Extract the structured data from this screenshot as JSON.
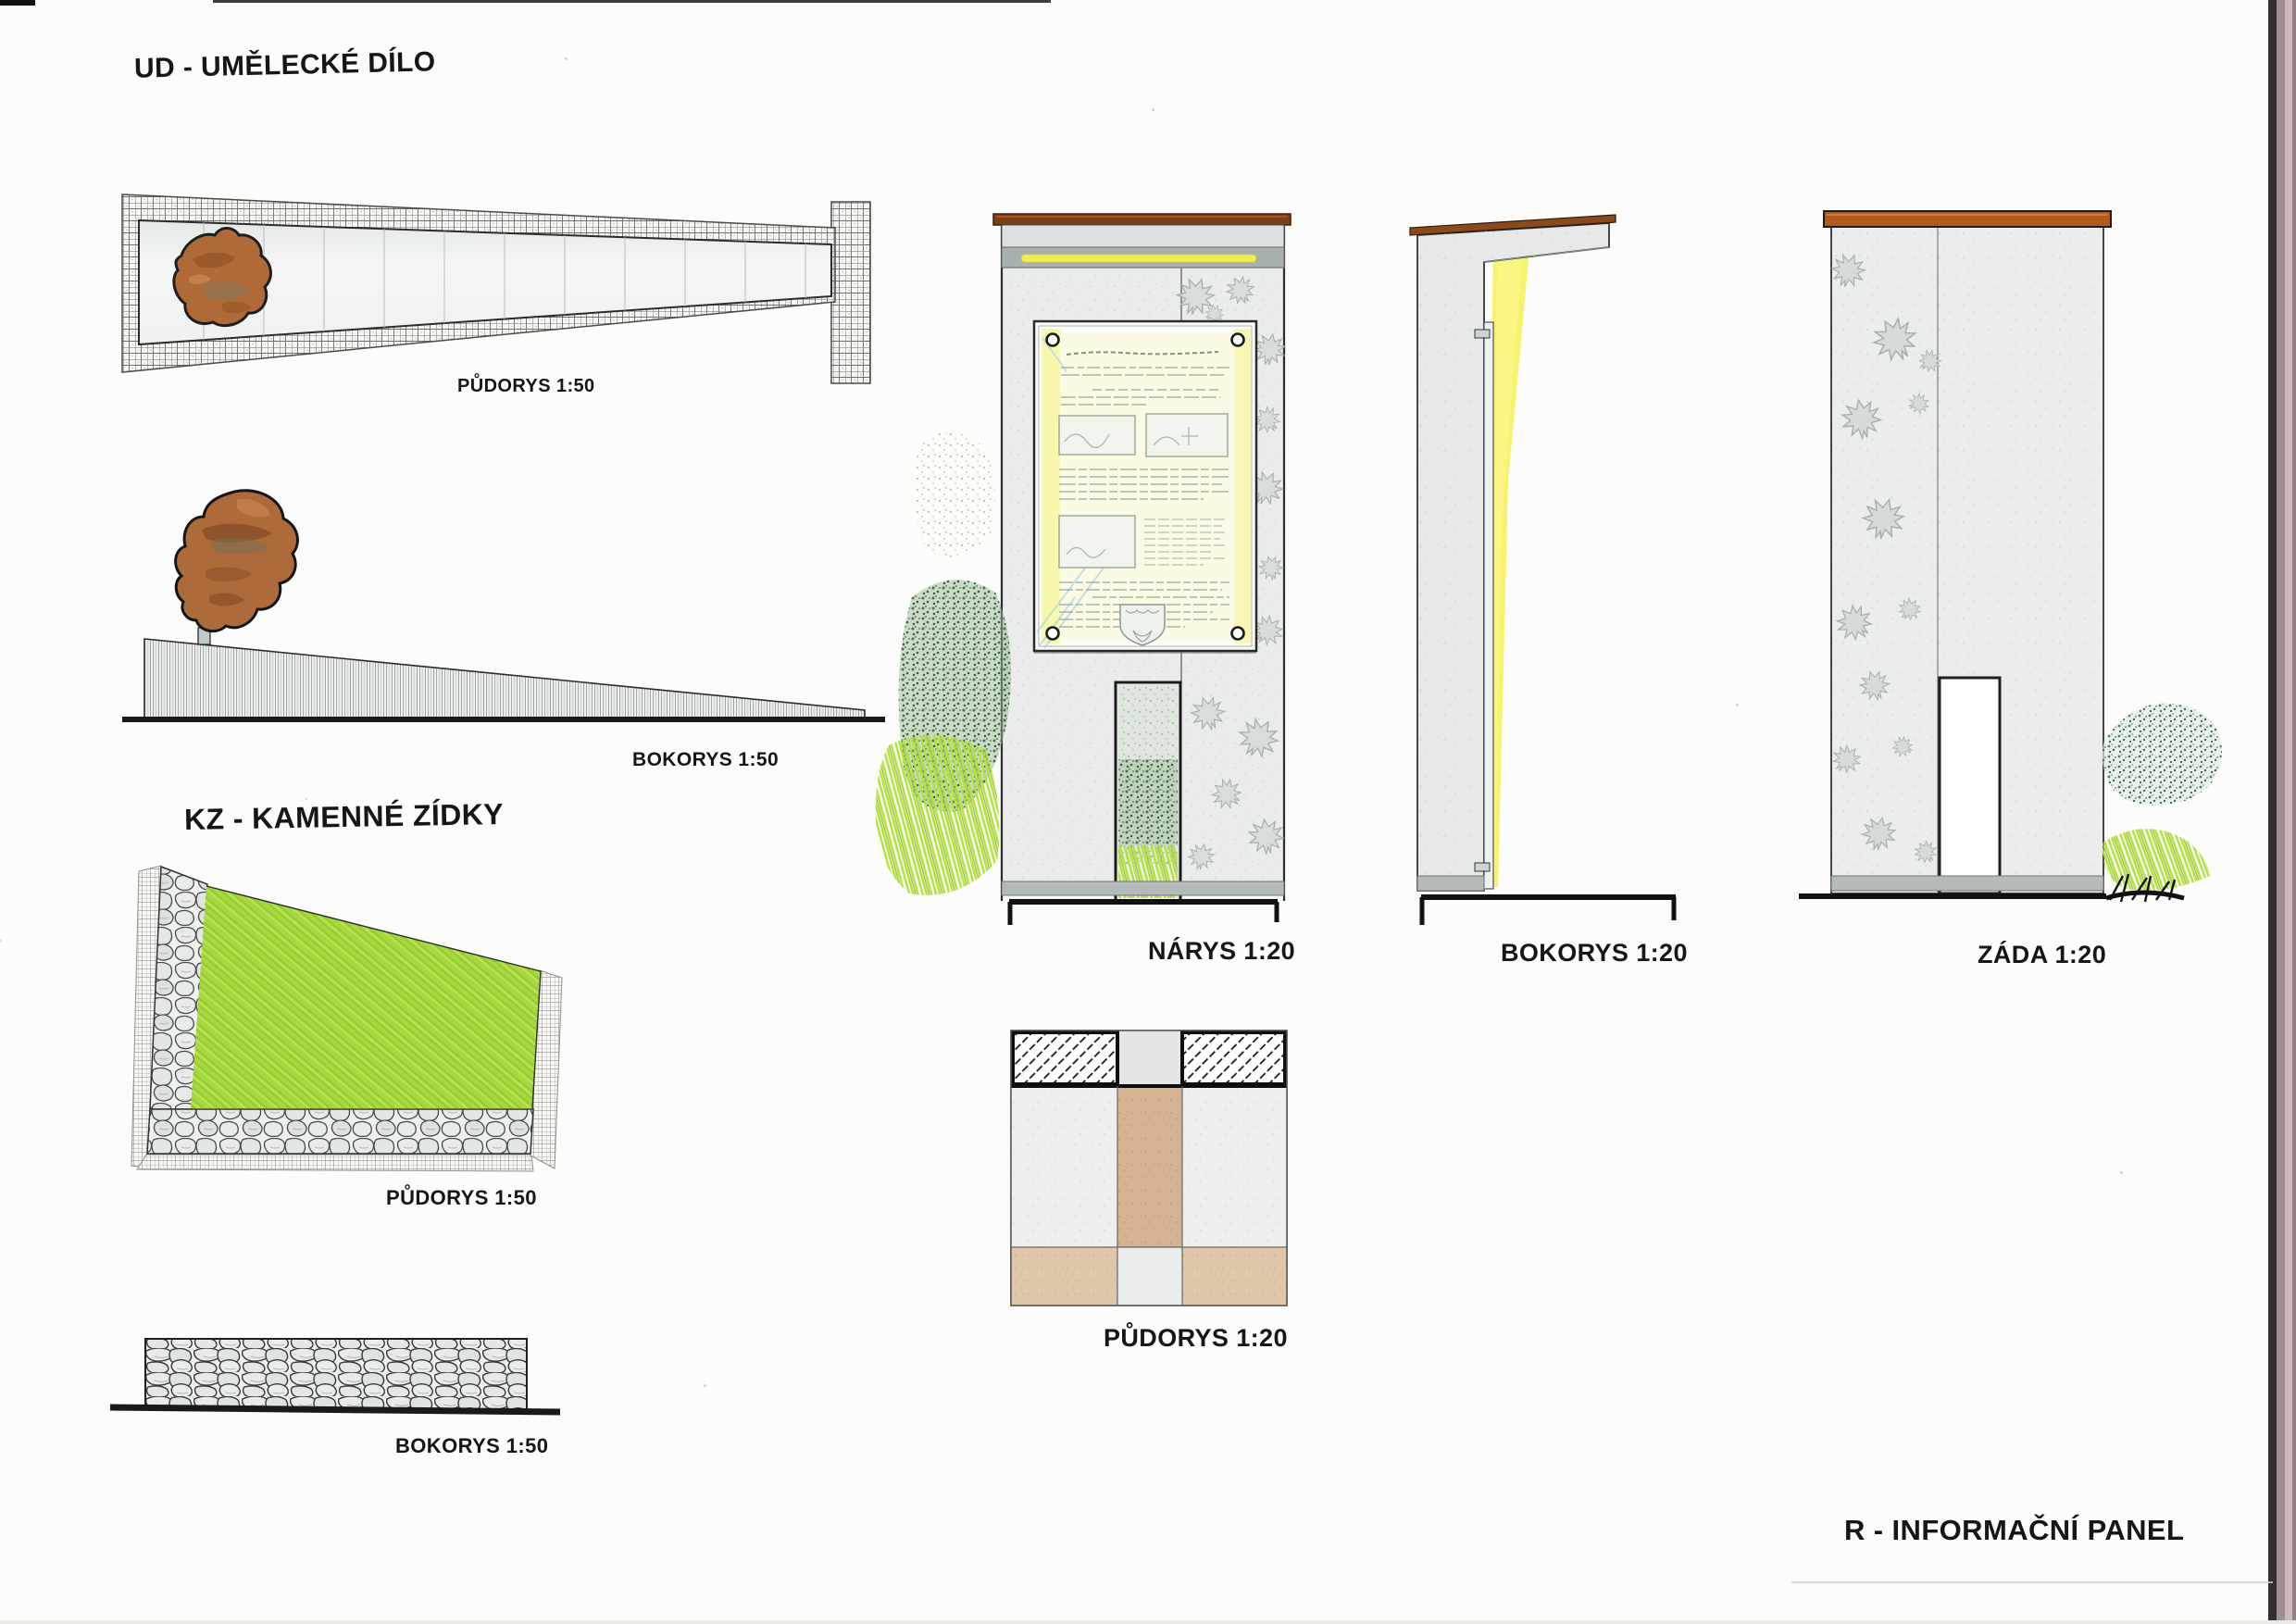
{
  "ud": {
    "heading": "UD - UMĚLECKÉ DÍLO",
    "plan_label": "PŮDORYS 1:50",
    "side_label": "BOKORYS 1:50"
  },
  "kz": {
    "heading": "KZ - KAMENNÉ ZÍDKY",
    "plan_label": "PŮDORYS 1:50",
    "side_label": "BOKORYS 1:50"
  },
  "panel": {
    "heading": "R - INFORMAČNÍ PANEL",
    "front_label": "NÁRYS 1:20",
    "side_label": "BOKORYS 1:20",
    "back_label": "ZÁDA 1:20",
    "plan_label": "PŮDORYS 1:20"
  },
  "colors": {
    "paper": "#fcfcfa",
    "ink": "#161616",
    "pencil_gray": "#e9ecea",
    "rock_brown": "#ad6a3a",
    "grass_green": "#a7d83d",
    "shrub_green": "#46724c",
    "lime_green": "#b4e043",
    "light_yellow": "#f3ee52",
    "cap_brown": "#7c3e17",
    "cap_orange": "#b25a1d",
    "wood_tan": "#d3b191"
  }
}
